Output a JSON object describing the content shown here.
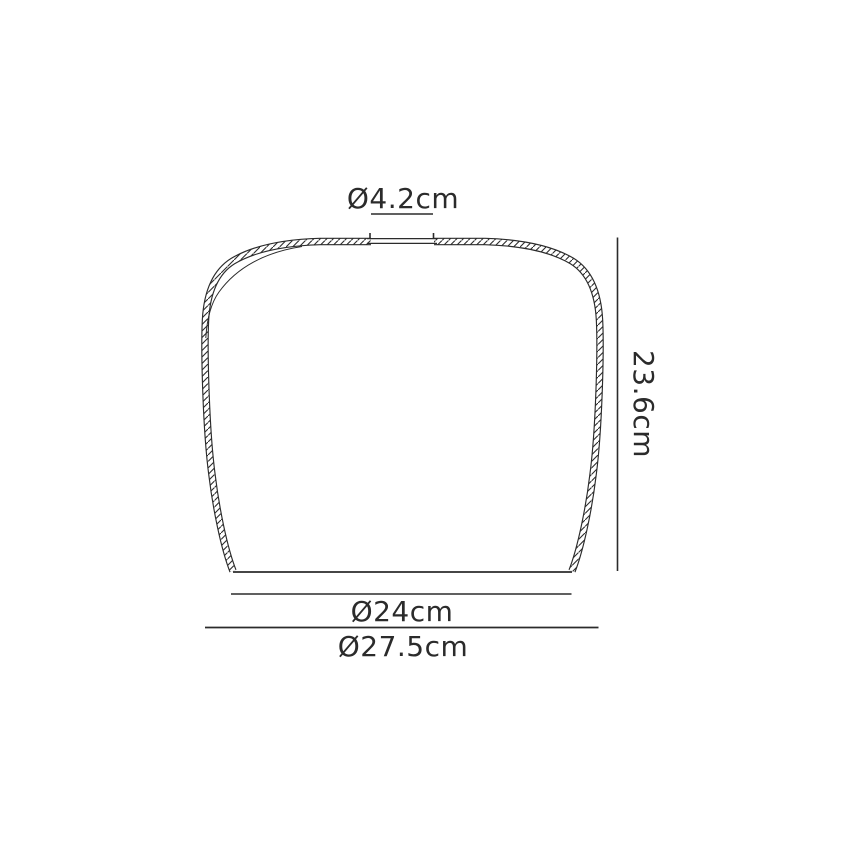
{
  "page": {
    "background_color": "#ffffff"
  },
  "drawing": {
    "line_color": "#2b2b2b",
    "dimensions": {
      "top_opening": {
        "label": "Ø4.2cm"
      },
      "height": {
        "label": "23.6cm"
      },
      "base_inner": {
        "label": "Ø24cm"
      },
      "base_outer": {
        "label": "Ø27.5cm"
      }
    }
  }
}
